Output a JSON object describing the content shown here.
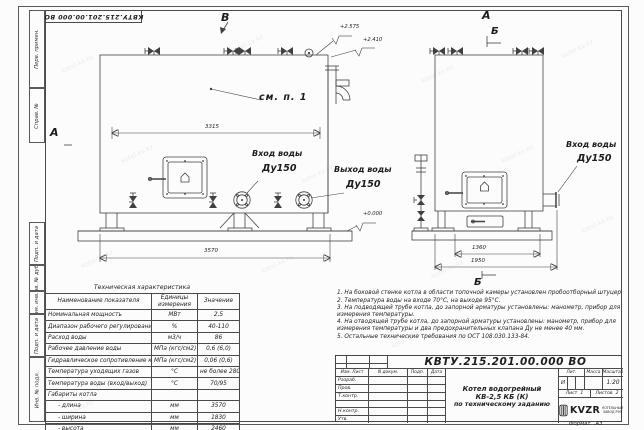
{
  "watermark": {
    "text": "kotel-kv.kz"
  },
  "frame": {
    "top_stamp": "КВТУ.215.201.00.000 ВО",
    "format_label": "Формат",
    "format_value": "А3",
    "margin_labels": [
      "Перв. примен.",
      "Справ. №",
      "Подп. и дата",
      "Инв. № дубл.",
      "Взам. инв. №",
      "Подп. и дата",
      "Инв. № подл."
    ]
  },
  "drawing": {
    "view_labels": {
      "front_a": "А",
      "front_b": "В",
      "side_a": "А",
      "side_b": "Б",
      "side_b_bottom": "Б"
    },
    "dims": {
      "front_top": "3315",
      "front_bottom": "3570",
      "side_inner": "1360",
      "side_outer": "1950"
    },
    "elevations": {
      "top": "+2.575",
      "roof": "+2.410",
      "zero": "+0.000"
    },
    "callout_see_note": "см. п. 1",
    "front_inlet": {
      "line1": "Вход воды",
      "line2": "Ду150"
    },
    "front_outlet": {
      "line1": "Выход воды",
      "line2": "Ду150"
    },
    "side_inlet": {
      "line1": "Вход воды",
      "line2": "Ду150"
    }
  },
  "spec_table": {
    "title": "Техническая характеристика",
    "col_name": "Наименование показателя",
    "col_units": "Единицы измерения",
    "col_value": "Значение",
    "rows": [
      {
        "name": "Номинальная мощность",
        "units": "МВт",
        "value": "2,5"
      },
      {
        "name": "Диапазон рабочего регулирования",
        "units": "%",
        "value": "40-110"
      },
      {
        "name": "Расход воды",
        "units": "м3/ч",
        "value": "86"
      },
      {
        "name": "Рабочее давление воды",
        "units": "МПа (кгс/см2)",
        "value": "0,6 (6,0)"
      },
      {
        "name": "Гидравлическое сопротивление котла",
        "units": "МПа (кгс/см2)",
        "value": "0,06 (0,6)"
      },
      {
        "name": "Температура уходящих газов",
        "units": "°С",
        "value": "не более 280"
      },
      {
        "name": "Температура воды (вход/выход)",
        "units": "°С",
        "value": "70/95"
      },
      {
        "name": "Габариты котла",
        "units": "",
        "value": ""
      },
      {
        "name": "- длина",
        "units": "мм",
        "value": "3570"
      },
      {
        "name": "- ширина",
        "units": "мм",
        "value": "1830"
      },
      {
        "name": "- высота",
        "units": "мм",
        "value": "2460"
      }
    ]
  },
  "notes": {
    "items": [
      "1. На боковой стенке котла в области топочной камеры установлен пробоотборный штуцер",
      "2. Температура воды на входе 70°С, на выходе 95°С.",
      "3. На подводящей трубе котла, до запорной арматуры установлены: манометр, прибор для измерения температуры.",
      "4. На отводящей трубе котла, до запорной арматуры установлены: манометр, прибор для измерения температуры и два предохранительных клапана Ду не менее 40 мм.",
      "5. Остальные технические требования по ОСТ 108.030.133-84."
    ]
  },
  "title_block": {
    "designation": "КВТУ.215.201.00.000 ВО",
    "rev_cols": {
      "c1": "Изм. Лист",
      "c2": "N докум.",
      "c3": "Подп.",
      "c4": "Дата"
    },
    "rev_rows": [
      "Разраб.",
      "Пров.",
      "Т.контр.",
      "",
      "Н.контр.",
      "Утв."
    ],
    "product_name_1": "Котел водогрейный",
    "product_name_2": "КВ-2,5 КБ (К)",
    "product_name_3": "по техническому заданию",
    "lit_label": "Лит.",
    "lit_value": "И",
    "mass_label": "Масса",
    "mass_value": "",
    "scale_label": "Масштаб",
    "scale_value": "1:20",
    "sheet_label": "Лист",
    "sheet_value": "1",
    "sheets_label": "Листов",
    "sheets_value": "2",
    "logo_text": "KVZR",
    "logo_sub1": "КОТЕЛЬНЫЙ",
    "logo_sub2": "ЗАВОД РЭП"
  }
}
